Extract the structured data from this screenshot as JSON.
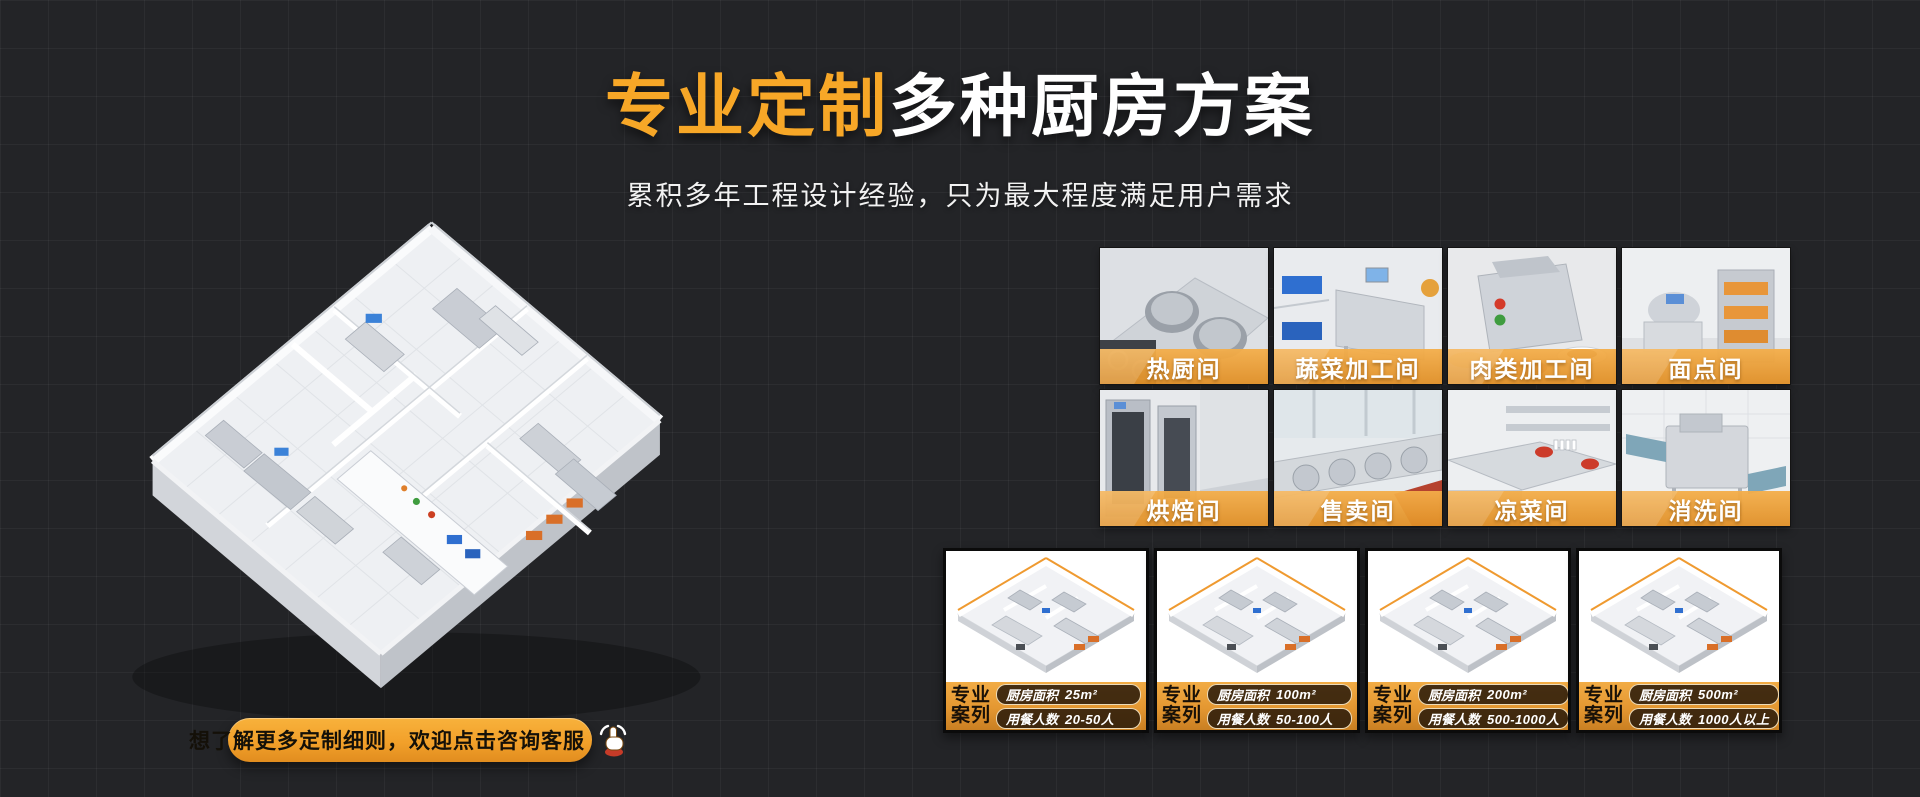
{
  "hero": {
    "title_highlight": "专业定制",
    "title_rest": "多种厨房方案",
    "subtitle": "累积多年工程设计经验，只为最大程度满足用户需求"
  },
  "cta": {
    "label": "想了解更多定制细则，欢迎点击咨询客服"
  },
  "colors": {
    "accent_orange": "#F7A727",
    "label_band": "#E9A03C",
    "background": "#232427",
    "card_pill_bg": "#261809"
  },
  "rooms": [
    {
      "label": "热厨间"
    },
    {
      "label": "蔬菜加工间"
    },
    {
      "label": "肉类加工间"
    },
    {
      "label": "面点间"
    },
    {
      "label": "烘焙间"
    },
    {
      "label": "售卖间"
    },
    {
      "label": "凉菜间"
    },
    {
      "label": "消洗间"
    }
  ],
  "cases": {
    "badge_line1": "专业",
    "badge_line2": "案列",
    "area_label": "厨房面积",
    "people_label": "用餐人数",
    "items": [
      {
        "area": "25m²",
        "people": "20-50人"
      },
      {
        "area": "100m²",
        "people": "50-100人"
      },
      {
        "area": "200m²",
        "people": "500-1000人"
      },
      {
        "area": "500m²",
        "people": "1000人以上"
      }
    ]
  }
}
